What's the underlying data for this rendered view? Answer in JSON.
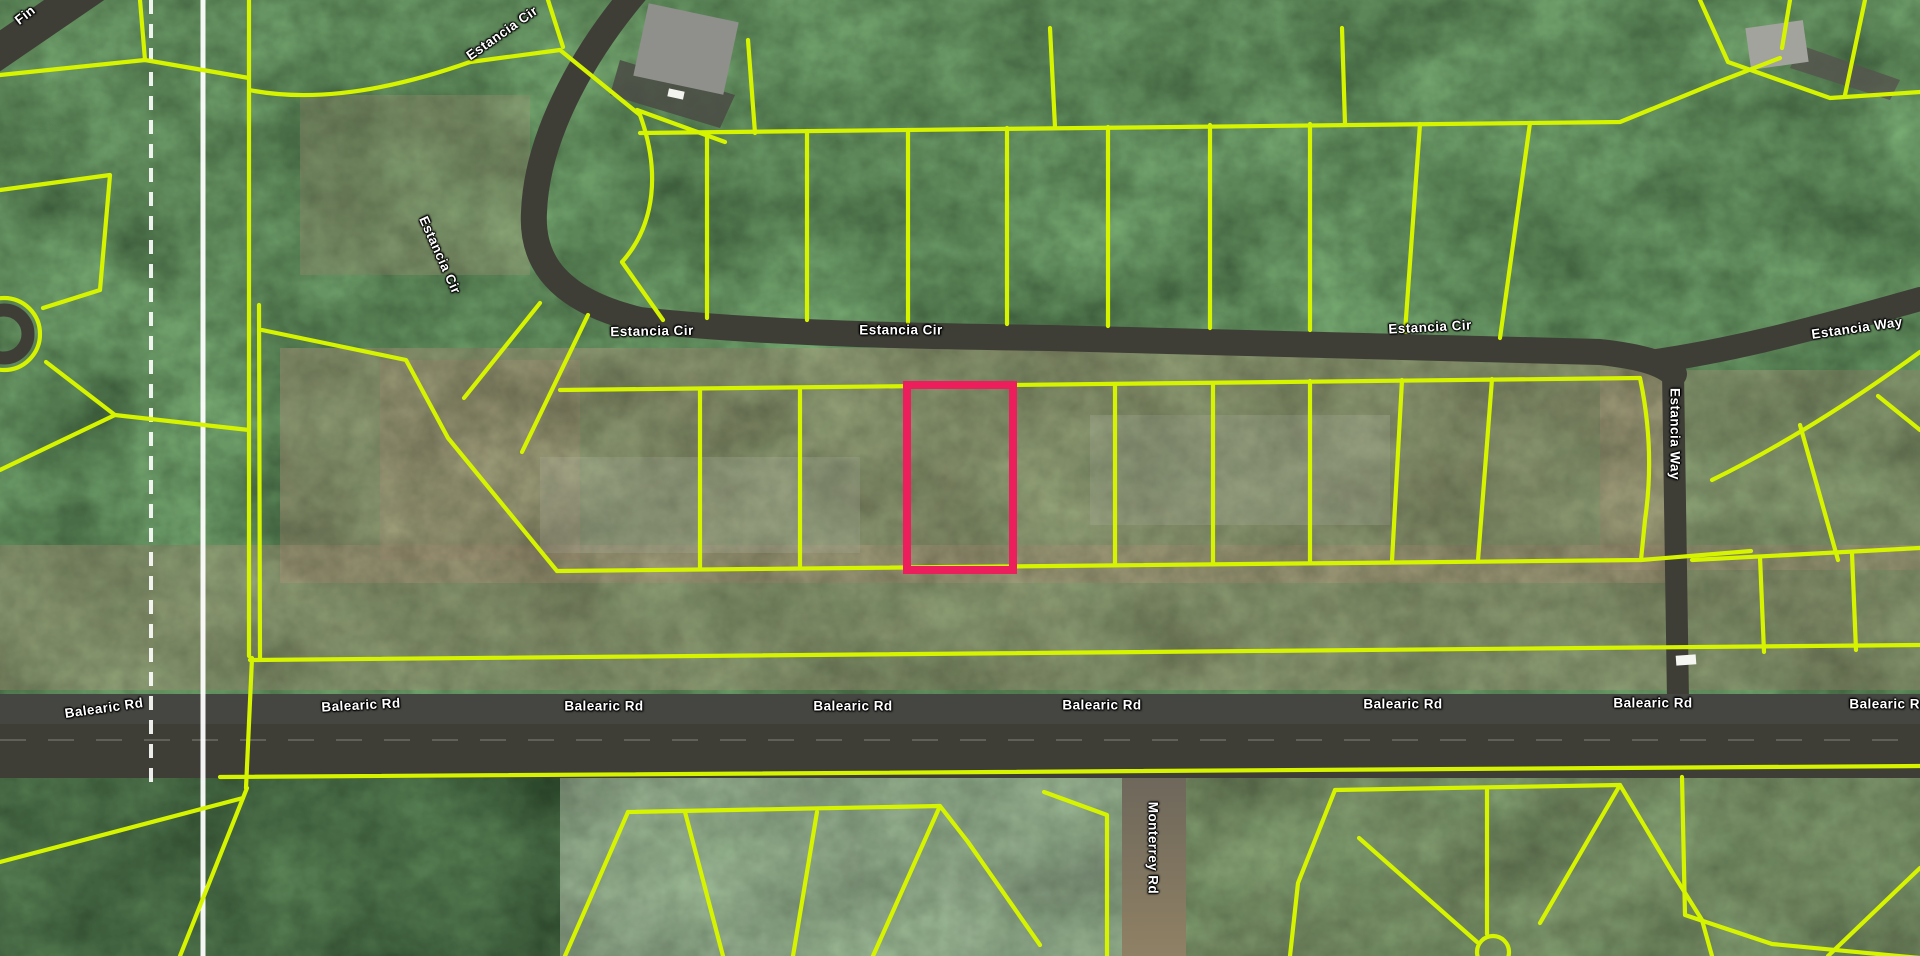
{
  "map": {
    "title": "Aerial parcel map with lot boundaries",
    "view": "satellite",
    "roads": [
      "Estancia Cir",
      "Estancia Way",
      "Balearic Rd",
      "Monterrey Rd"
    ],
    "partial_road_label_top_left": "Fin",
    "highlighted_parcel": {
      "x": 907,
      "y": 385,
      "w": 106,
      "h": 185
    }
  },
  "labels": [
    {
      "text": "Fin"
    },
    {
      "text": "Estancia Cir"
    },
    {
      "text": "Estancia Cir"
    },
    {
      "text": "Estancia Cir"
    },
    {
      "text": "Estancia Cir"
    },
    {
      "text": "Estancia Cir"
    },
    {
      "text": "Estancia Way"
    },
    {
      "text": "Estancia Way"
    },
    {
      "text": "Balearic Rd"
    },
    {
      "text": "Balearic Rd"
    },
    {
      "text": "Balearic Rd"
    },
    {
      "text": "Balearic Rd"
    },
    {
      "text": "Balearic Rd"
    },
    {
      "text": "Balearic Rd"
    },
    {
      "text": "Balearic Rd"
    },
    {
      "text": "Balearic Rd"
    },
    {
      "text": "Monterrey Rd"
    }
  ],
  "colors": {
    "parcel_line": "#D6F400",
    "highlight": "#EC1E5C",
    "road_fill": "#3E3E37",
    "label_text": "#FFFFFF",
    "section_line": "#FFFFFF"
  }
}
